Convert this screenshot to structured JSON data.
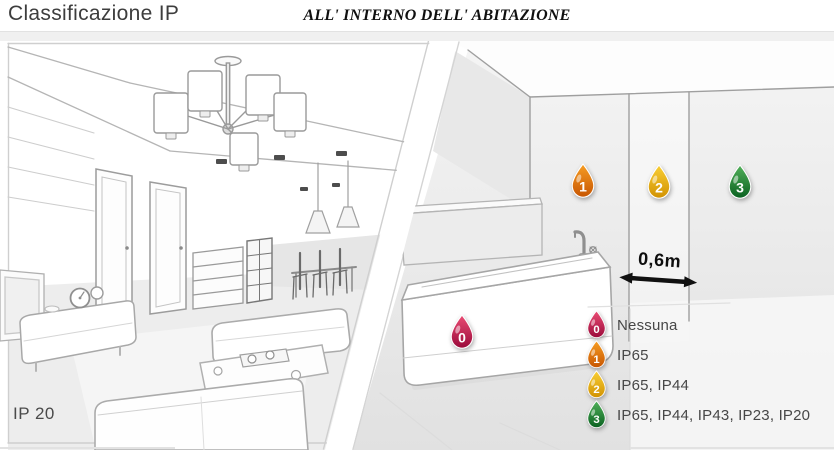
{
  "header": {
    "title": "Classificazione IP",
    "subtitle": "ALL' INTERNO DELL' ABITAZIONE"
  },
  "left_scene": {
    "description": "living room line drawing",
    "label": "IP 20"
  },
  "right_scene": {
    "description": "bathroom line drawing with bathtub",
    "measurement": "0,6m",
    "zones": [
      {
        "number": "0",
        "label": "Nessuna",
        "color": "#c21a4e",
        "color_light": "#e84a72",
        "color_dark": "#9c0c3c"
      },
      {
        "number": "1",
        "label": "IP65",
        "color": "#e2700f",
        "color_light": "#f59b22",
        "color_dark": "#c85703"
      },
      {
        "number": "2",
        "label": "IP65, IP44",
        "color": "#e9af0b",
        "color_light": "#f8cd33",
        "color_dark": "#d29303"
      },
      {
        "number": "3",
        "label": "IP65, IP44, IP43, IP23, IP20",
        "color": "#1f8a38",
        "color_light": "#4fae58",
        "color_dark": "#0c6322"
      }
    ]
  }
}
